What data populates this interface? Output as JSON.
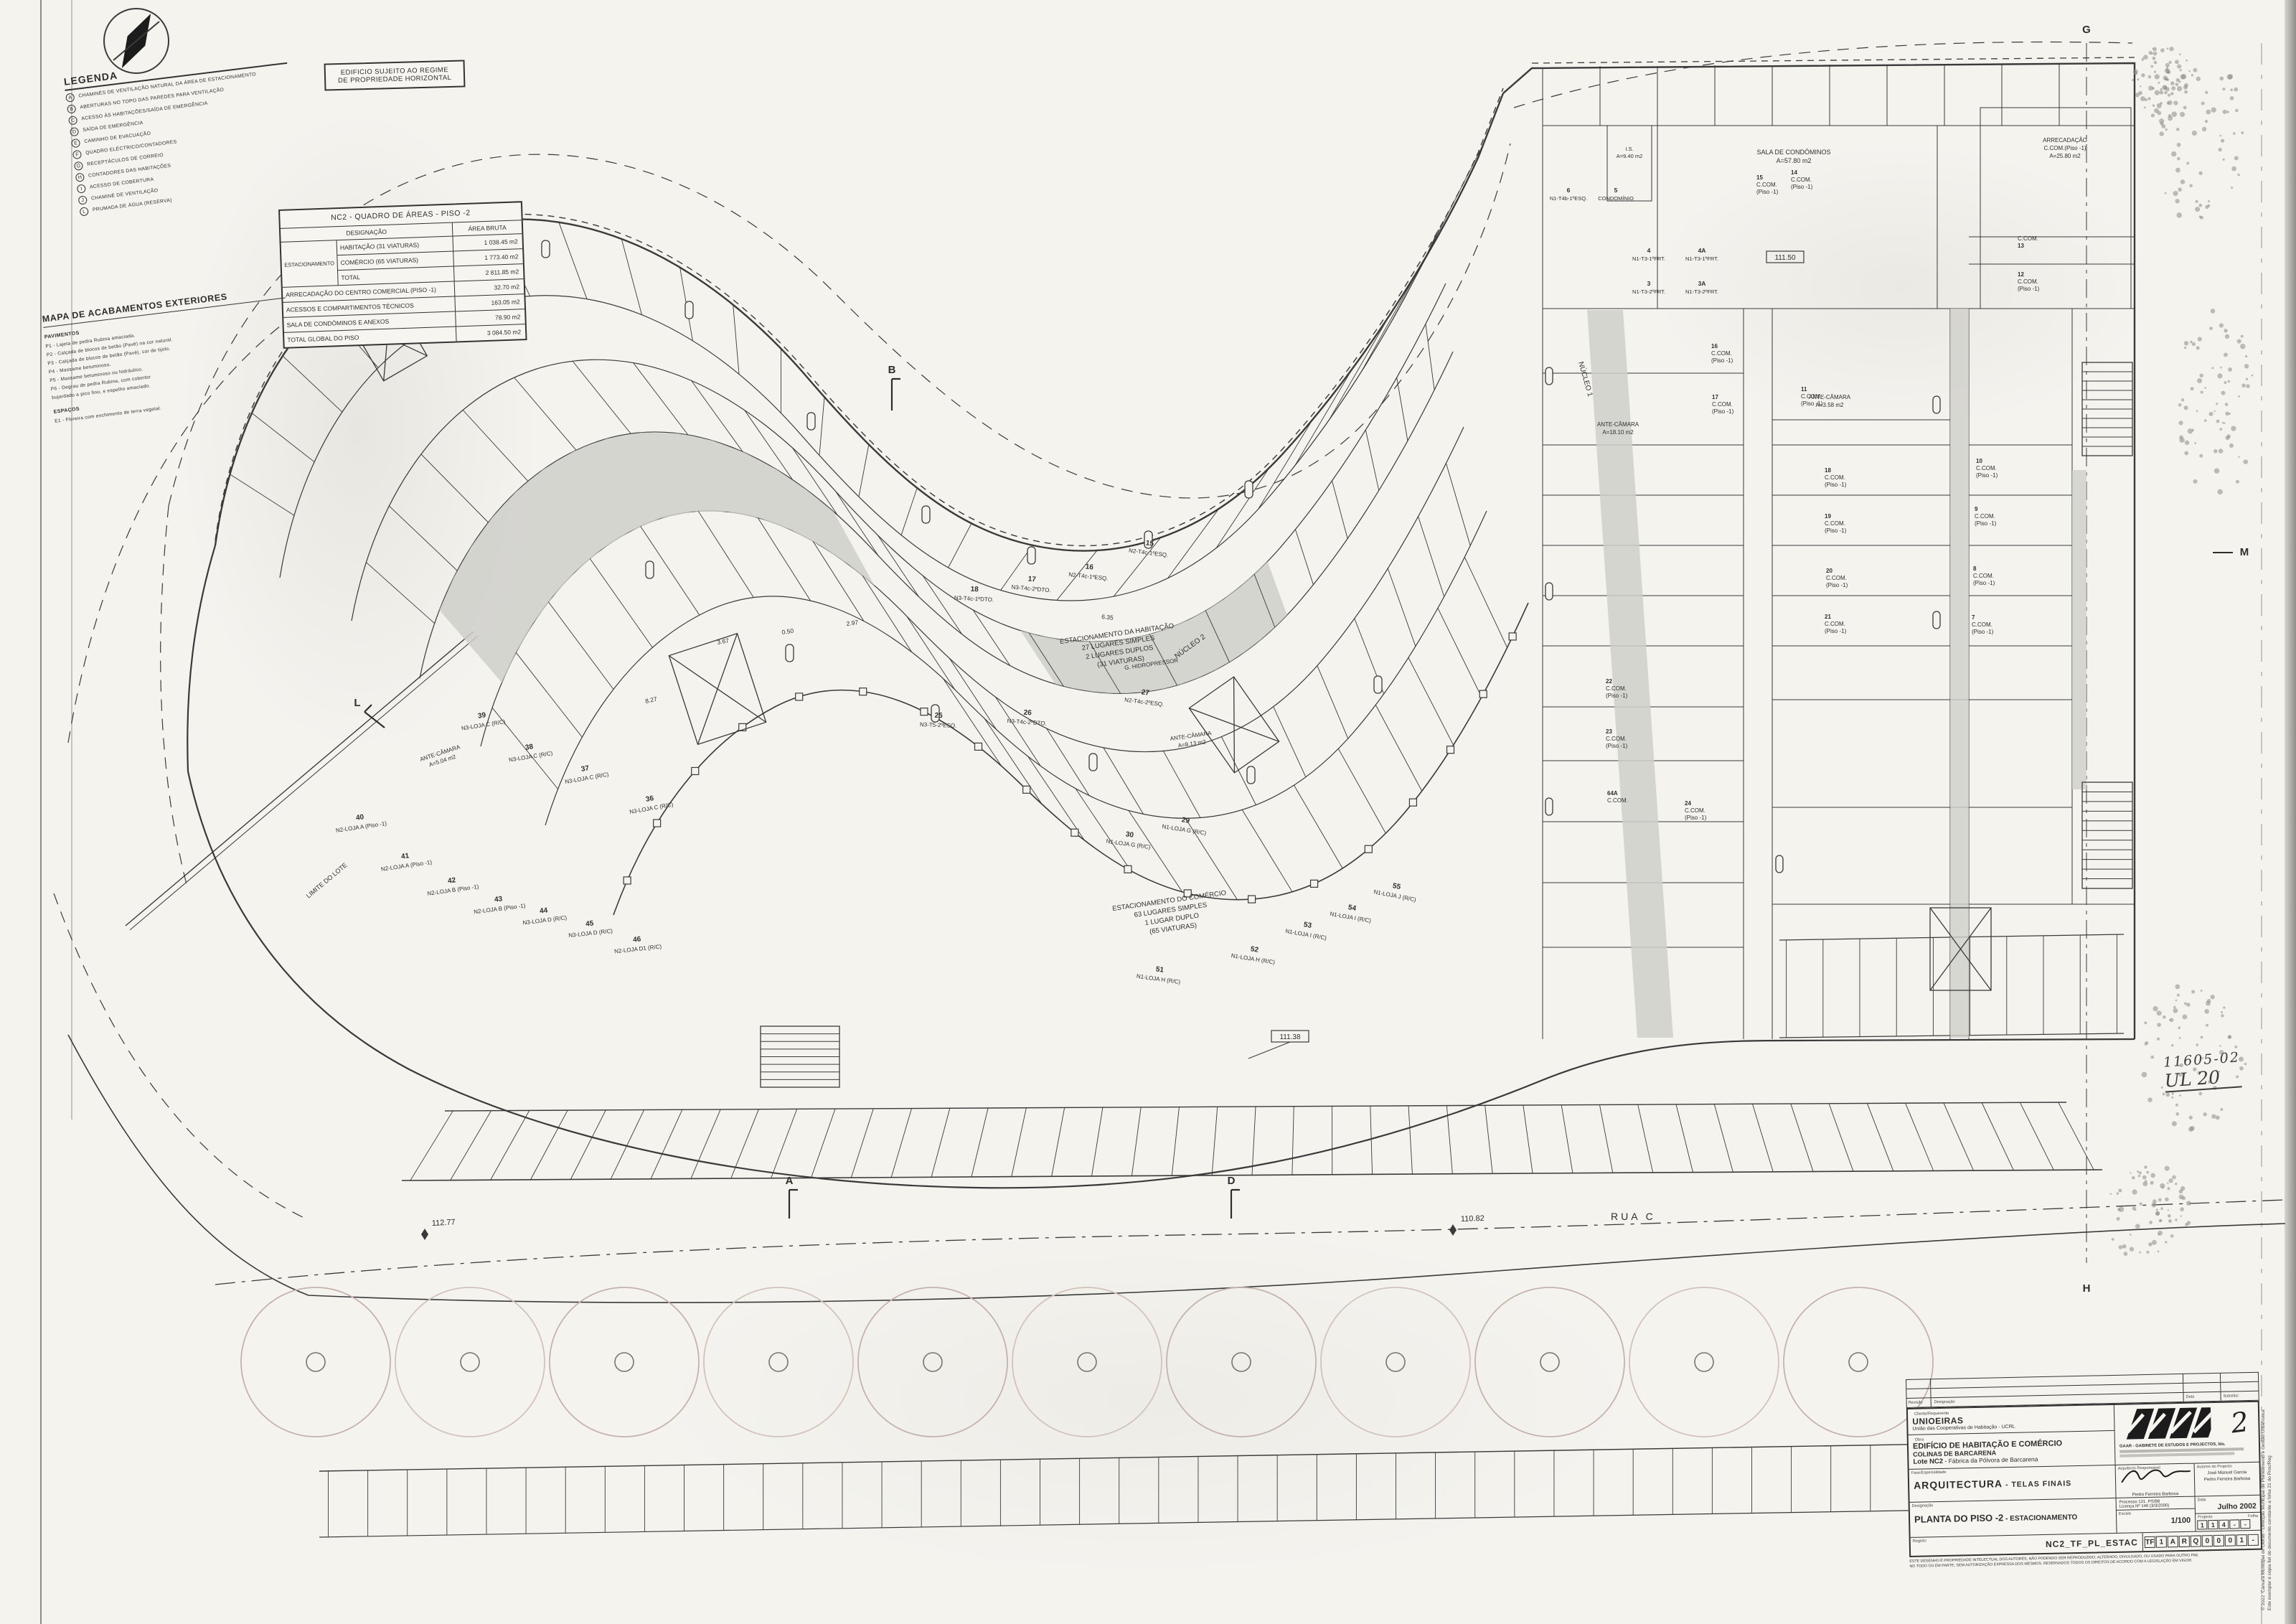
{
  "sheet": {
    "number": "2",
    "scale": "1/100",
    "date": "Julho 2002"
  },
  "north": "N",
  "notice": {
    "line1": "EDIFICIO SUJEITO AO REGIME",
    "line2": "DE PROPRIEDADE HORIZONTAL"
  },
  "legend": {
    "title": "LEGENDA",
    "items": [
      {
        "k": "A",
        "label": "CHAMINÉS DE VENTILAÇÃO NATURAL DA ÁREA DE ESTACIONAMENTO"
      },
      {
        "k": "B",
        "label": "ABERTURAS NO TOPO DAS PAREDES PARA VENTILAÇÃO"
      },
      {
        "k": "C",
        "label": "ACESSO ÀS HABITAÇÕES/SAÍDA DE EMERGÊNCIA"
      },
      {
        "k": "D",
        "label": "SAÍDA DE EMERGÊNCIA"
      },
      {
        "k": "E",
        "label": "CAMINHO DE EVACUAÇÃO"
      },
      {
        "k": "F",
        "label": "QUADRO ELÉCTRICO/CONTADORES"
      },
      {
        "k": "G",
        "label": "RECEPTÁCULOS DE CORREIO"
      },
      {
        "k": "H",
        "label": "CONTADORES DAS HABITAÇÕES"
      },
      {
        "k": "I",
        "label": "ACESSO DE COBERTURA"
      },
      {
        "k": "J",
        "label": "CHAMINÉ DE VENTILAÇÃO"
      },
      {
        "k": "L",
        "label": "PRUMADA DE ÁGUA (RESERVA)"
      }
    ]
  },
  "areas_table": {
    "title": "NC2 - QUADRO DE ÁREAS - PISO -2",
    "col_designacao": "DESIGNAÇÃO",
    "col_area": "ÁREA BRUTA",
    "group_label": "ESTACIONAMENTO",
    "group_rows": [
      {
        "d": "HABITAÇÃO (31 VIATURAS)",
        "a": "1 038.45 m2"
      },
      {
        "d": "COMÉRCIO (65 VIATURAS)",
        "a": "1 773.40 m2"
      },
      {
        "d": "TOTAL",
        "a": "2 811.85 m2"
      }
    ],
    "rows": [
      {
        "d": "ARRECADAÇÃO DO CENTRO COMERCIAL (PISO -1)",
        "a": "32.70 m2"
      },
      {
        "d": "ACESSOS E COMPARTIMENTOS TÉCNICOS",
        "a": "163.05 m2"
      },
      {
        "d": "SALA DE CONDÓMINOS E ANEXOS",
        "a": "78.90 m2"
      },
      {
        "d": "TOTAL GLOBAL DO PISO",
        "a": "3 084.50 m2"
      }
    ]
  },
  "finishes": {
    "title": "MAPA DE ACABAMENTOS EXTERIORES",
    "sub1": "PAVIMENTOS",
    "pavimentos": [
      "P1 - Lajeta de pedra Rubina amaciada.",
      "P2 - Calçada de blocos de betão (Pavê) na cor natural.",
      "P3 - Calçada de blocos de betão (Pavê), cor de tijolo.",
      "P4 - Massame betuminoso.",
      "P5 - Massame betuminoso ou hidráulico.",
      "P6 - Degrau de pedra Rubina, com cobertor",
      "        bujardado a pico fino, e espelho amaciado."
    ],
    "sub2": "ESPAÇOS",
    "espacos": [
      "E1 - Floreira com enchimento de terra vegetal."
    ]
  },
  "plan": {
    "street": "RUA C",
    "lot_edge": "LIMITE DO LOTE",
    "levels": {
      "l1": "111.50",
      "l2": "111.38"
    },
    "dims": {
      "d1": "112.77",
      "d2": "110.82"
    },
    "dims_small": [
      "3.67",
      "0.50",
      "2.97",
      "6.35",
      "8.27"
    ],
    "parking_hab": [
      "ESTACIONAMENTO DA HABITAÇÃO",
      "27 LUGARES SIMPLES",
      "2 LUGARES DUPLOS",
      "(31 VIATURAS)"
    ],
    "parking_com": [
      "ESTACIONAMENTO DO COMÉRCIO",
      "63 LUGARES SIMPLES",
      "1 LUGAR DUPLO",
      "(65 VIATURAS)"
    ],
    "nucleos": [
      "NÚCLEO 1",
      "NÚCLEO 2",
      "NÚCLEO 3"
    ],
    "rooms": {
      "sala": [
        "SALA DE CONDÓMINOS",
        "A=57.80 m2"
      ],
      "arrec": [
        "ARRECADAÇÃO",
        "C.COM.(Piso -1)",
        "A=25.80 m2"
      ],
      "ante1": [
        "ANTE-CÂMARA",
        "A=18.10 m2"
      ],
      "ante2": [
        "ANTE-CÂMARA",
        "A=8.13 m2"
      ],
      "ante3": [
        "ANTE-CÂMARA",
        "A=3.58 m2"
      ],
      "ante4": [
        "ANTE-CÂMARA",
        "A=5.04 m2"
      ],
      "hidro": "G. HIDROPRESSOR",
      "is": [
        "I.S.",
        "A=9.40 m2"
      ]
    },
    "apartments": [
      {
        "n": "6",
        "u": "N1-T4b-1ºESQ."
      },
      {
        "n": "5",
        "u": "CONDOMÍNIO"
      },
      {
        "n": "4",
        "u": "N1-T3-1ºFRT."
      },
      {
        "n": "4A",
        "u": "N1-T3-1ºFRT."
      },
      {
        "n": "3",
        "u": "N1-T3-2ºFRT."
      },
      {
        "n": "3A",
        "u": "N1-T3-2ºFRT."
      }
    ],
    "ccom_label": [
      "C.COM.",
      "(Piso -1)"
    ],
    "ccom_cells": [
      "7",
      "8",
      "9",
      "10",
      "11",
      "12",
      "13",
      "14",
      "15",
      "16",
      "17",
      "18",
      "19",
      "20",
      "21",
      "22",
      "23",
      "24",
      "64A"
    ],
    "stalls": [
      {
        "n": "15",
        "u": "N2-T4c-1ºESQ."
      },
      {
        "n": "16",
        "u": "N2-T4c-1ºESQ."
      },
      {
        "n": "17",
        "u": "N3-T4c-2ºDTO."
      },
      {
        "n": "18",
        "u": "N3-T4c-1ºDTO."
      },
      {
        "n": "25",
        "u": "N3-T5-2ºESQ."
      },
      {
        "n": "26",
        "u": "N3-T4c-2ºDTO."
      },
      {
        "n": "27",
        "u": "N2-T4c-2ºESQ."
      },
      {
        "n": "29",
        "u": "N1-LOJA G (R/C)"
      },
      {
        "n": "30",
        "u": "N1-LOJA G (R/C)"
      },
      {
        "n": "36",
        "u": "N3-LOJA C (R/C)"
      },
      {
        "n": "37",
        "u": "N3-LOJA C (R/C)"
      },
      {
        "n": "38",
        "u": "N3-LOJA C (R/C)"
      },
      {
        "n": "39",
        "u": "N3-LOJA C (R/C)"
      },
      {
        "n": "40",
        "u": "N2-LOJA A (Piso -1)"
      },
      {
        "n": "41",
        "u": "N2-LOJA A (Piso -1)"
      },
      {
        "n": "42",
        "u": "N2-LOJA B (Piso -1)"
      },
      {
        "n": "43",
        "u": "N2-LOJA B (Piso -1)"
      },
      {
        "n": "44",
        "u": "N3-LOJA D (R/C)"
      },
      {
        "n": "45",
        "u": "N3-LOJA D (R/C)"
      },
      {
        "n": "46",
        "u": "N2-LOJA D1 (R/C)"
      },
      {
        "n": "51",
        "u": "N1-LOJA H (R/C)"
      },
      {
        "n": "52",
        "u": "N1-LOJA H (R/C)"
      },
      {
        "n": "53",
        "u": "N1-LOJA I (R/C)"
      },
      {
        "n": "54",
        "u": "N1-LOJA I (R/C)"
      },
      {
        "n": "55",
        "u": "N1-LOJA J (R/C)"
      }
    ],
    "markers": {
      "a": "A",
      "b": "B",
      "d": "D",
      "g": "G",
      "h": "H",
      "l": "L",
      "m": "M"
    }
  },
  "titleblock": {
    "rev_header": {
      "revisao": "Revisão",
      "designacao": "Designação",
      "data": "Data",
      "substitui": "Substitui"
    },
    "client_label": "Cliente/Requerente",
    "client_name": "UNIOEIRAS",
    "client_sub": "União das Cooperativas de Habitação - UCRL",
    "obra_label": "Obra",
    "obra1": "EDIFÍCIO DE HABITAÇÃO E COMÉRCIO",
    "obra2": "COLINAS DE BARCARENA",
    "obra3_b": "Lote NC2",
    "obra3": " - Fábrica da Pólvora de Barcarena",
    "firm": "GAAR - GABINETE DE ESTUDOS E PROJECTOS, lda.",
    "fase_label": "Fase/Especialidade",
    "fase_value": "ARQUITECTURA",
    "fase_value2": " - TELAS FINAIS",
    "resp_label": "Arquitecto Responsável",
    "resp_name": "Pedro Ferreira Barbosa",
    "aut_label": "Autores do Projecto",
    "aut_name1": "José Manuel Garcia",
    "aut_name2": "Pedro Ferreira Barbosa",
    "processo": "Processo 121. PS/98",
    "licenca": "Licença Nº 146 (3/3/2000)",
    "data_label": "Data",
    "data_value": "Julho 2002",
    "escala_label": "Escala",
    "escala_value": "1/100",
    "projecto_label": "Projecto",
    "folha_label": "Folha",
    "projecto_cells": [
      "1",
      "1",
      "4",
      "-",
      "-"
    ],
    "des_label": "Designação",
    "des_value": "PLANTA DO PISO -2",
    "des_value2": " - ESTACIONAMENTO",
    "reg_label": "Registo",
    "reg_value": "NC2_TF_PL_ESTAC",
    "reg_cells": [
      "TF",
      "1",
      "A",
      "R",
      "Q",
      "0",
      "0",
      "0",
      "1",
      "-"
    ],
    "disclaimer1": "ESTE DESENHO É PROPRIEDADE INTELECTUAL DOS AUTORES, NÃO PODENDO SER REPRODUZIDO, ALTERADO, DIVULGADO, OU USADO PARA OUTRO FIM,",
    "disclaimer2": "NO TODO OU EM PARTE, SEM AUTORIZAÇÃO EXPRESSA DOS MESMOS. RESERVADOS TODOS OS DIREITOS DE ACORDO COM A LEGISLAÇÃO EM VIGOR."
  },
  "stamp": {
    "copyright": "© 2022",
    "line1": "Câmara Municipal de Oeiras - Direcção Municipal de Planeamento e Gestão Urbanística",
    "line2": "Este exemplar é cópia fiel do documento constante a folha 21 do Proc/Reg"
  },
  "handwritten": {
    "ref1": "11605-02",
    "ref2": "UL 20"
  }
}
